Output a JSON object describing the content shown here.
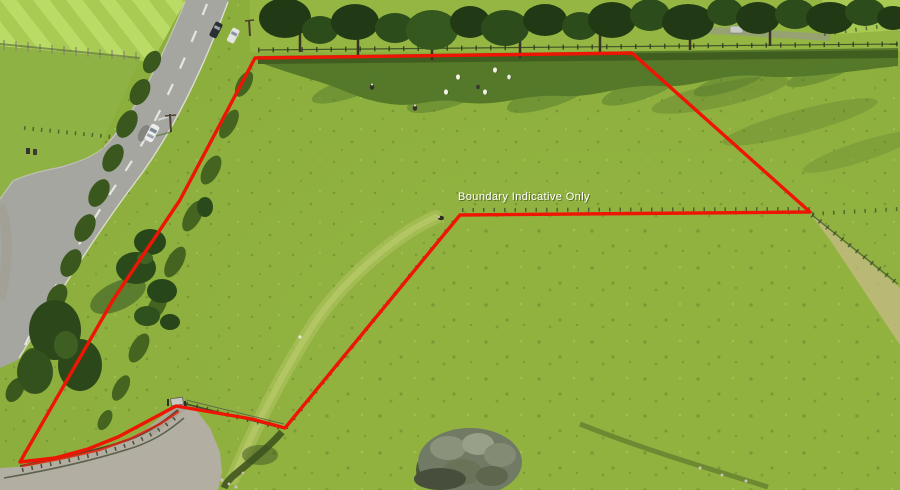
{
  "overlay": {
    "label": "Boundary Indicative Only",
    "label_color": "#ffffff",
    "boundary_color": "#ee1505",
    "boundary_points": "255,58 632,53 810,212 460,215 285,428 252,419 176,406 148,421 118,437 88,449 55,458 20,462 113,300 180,200",
    "boundary_fence_points": "22,466 60,459 100,450 132,438 160,424 178,412"
  },
  "palette": {
    "field_green": "#8cae3d",
    "bright_field_green": "#aacb55",
    "tree_green": "#27461a",
    "shadow_green": "#4c7026",
    "road_gray": "#a6a6a1",
    "gravel_gray": "#b3aea2",
    "dry_grass_tan": "#c3ba82",
    "boundary_red": "#ee1505",
    "label_white": "#ffffff"
  }
}
